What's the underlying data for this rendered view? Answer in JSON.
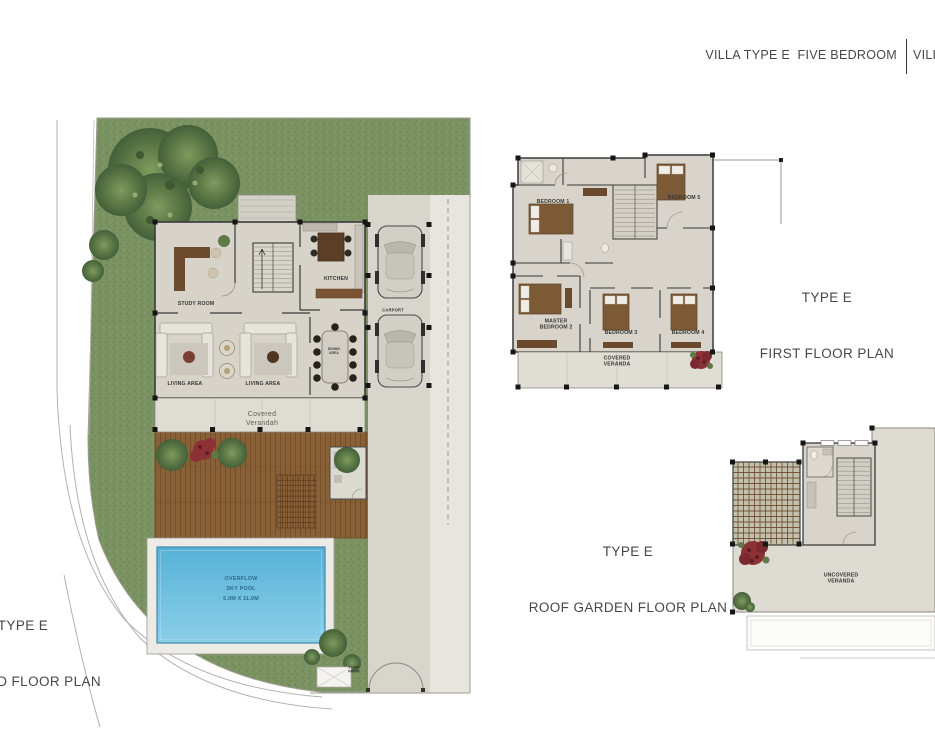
{
  "header": {
    "current_plan_title": "VILLA TYPE E  FIVE BEDROOM",
    "adjacent_plan_title_partial": "VILLA"
  },
  "plans": {
    "ground": {
      "title": "TYPE E",
      "subtitle": "GROUND FLOOR PLAN",
      "labels": {
        "study_room": "STUDY ROOM",
        "kitchen": "KITCHEN",
        "living_area_left": "LIVING AREA",
        "living_area_right": "LIVING AREA",
        "dining_area": "DINING\nAREA",
        "covered_verandah": "Covered\nVerandah",
        "carport": "CARPORT",
        "pool": "OVERFLOW\nSKY POOL\n5.0M X 11.0M",
        "pump_room": "PUMP\nROOM"
      }
    },
    "first": {
      "title": "TYPE E",
      "subtitle": "FIRST FLOOR PLAN",
      "labels": {
        "bedroom1": "BEDROOM 1",
        "bedroom5": "BEDROOM 5",
        "master_bedroom2": "MASTER\nBEDROOM 2",
        "bedroom3": "BEDROOM 3",
        "bedroom4": "BEDROOM 4",
        "covered_veranda": "COVERED\nVERANDA"
      }
    },
    "roof": {
      "title": "TYPE E",
      "subtitle": "ROOF GARDEN FLOOR PLAN",
      "labels": {
        "uncovered_veranda": "UNCOVERED\nVERANDA"
      }
    }
  },
  "colors": {
    "grass": "#7b9363",
    "floor": "#d7d3c9",
    "wood_deck": "#8a6036",
    "pool_water": "#66bbdd",
    "walls": "#3a3a3a",
    "plant_red": "#8c3136",
    "heading_text": "#474747"
  }
}
